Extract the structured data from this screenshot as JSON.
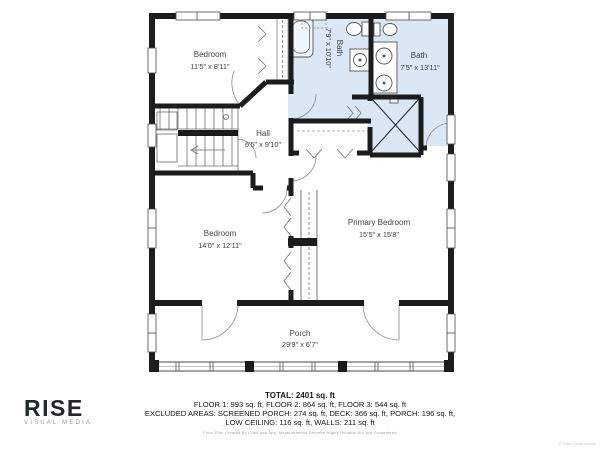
{
  "branding": {
    "logo": "RISE",
    "tagline": "VISUAL MEDIA"
  },
  "floor_plan": {
    "rooms": {
      "bedroom_upper": {
        "name": "Bedroom",
        "dims": "11'5\" x 8'11\""
      },
      "bath_small": {
        "name": "Bath",
        "dims": "7'9\" x 10'10\""
      },
      "bath_large": {
        "name": "Bath",
        "dims": "7'5\" x 13'11\""
      },
      "hall": {
        "name": "Hall",
        "dims": "6'5\" x 9'10\""
      },
      "bedroom_lower": {
        "name": "Bedroom",
        "dims": "14'0\" x 12'11\""
      },
      "primary_bedroom": {
        "name": "Primary Bedroom",
        "dims": "15'5\" x 15'8\""
      },
      "porch": {
        "name": "Porch",
        "dims": "29'9\" x 6'7\""
      }
    }
  },
  "summary": {
    "total": "TOTAL: 2401 sq. ft",
    "floors": "FLOOR 1: 993 sq. ft, FLOOR 2: 864 sq. ft, FLOOR 3: 544 sq. ft",
    "excluded": "EXCLUDED AREAS: SCREENED PORCH: 274 sq. ft, DECK: 366 sq. ft, PORCH: 196 sq. ft,",
    "excluded2": "LOW CEILING: 116 sq. ft, WALLS: 211 sq. ft",
    "disclaimer": "Floor Plan Created By CubiCasa App. Measurements Deemed Highly Reliable But Not Guaranteed"
  },
  "watermark": "© Rise Visual Media",
  "colors": {
    "bath_fill": "#d9e8f4",
    "wall": "#1c1c1e",
    "label": "#3d4247"
  }
}
